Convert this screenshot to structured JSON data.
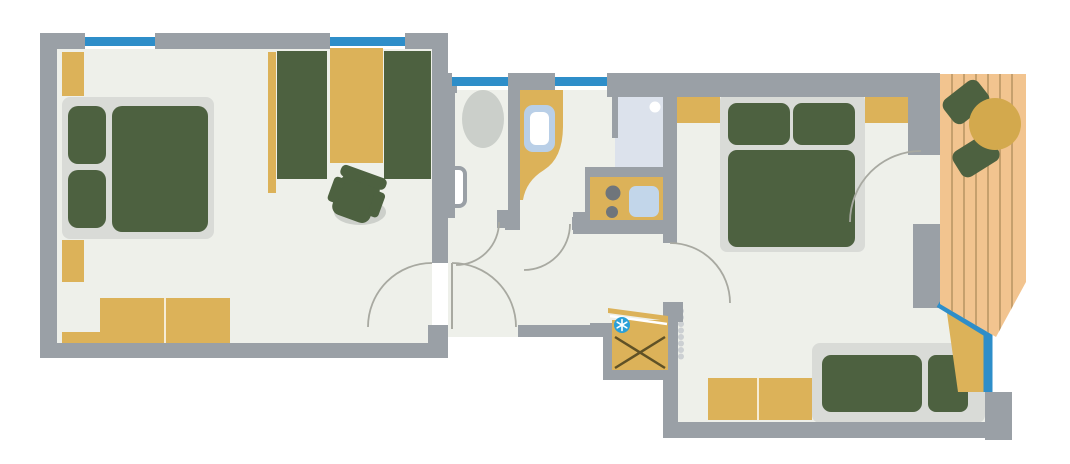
{
  "plan": {
    "type": "apartment-floor-plan",
    "rooms": [
      {
        "name": "bedroom-living-left",
        "furniture": [
          "double-bed",
          "wardrobe",
          "wall-cabinet",
          "sideboard",
          "seating-bench-left",
          "seating-bench-right",
          "desk",
          "desk-chair"
        ]
      },
      {
        "name": "wc",
        "furniture": [
          "toilet",
          "hand-basin"
        ]
      },
      {
        "name": "bathroom",
        "furniture": [
          "vanity-counter",
          "washbasin"
        ]
      },
      {
        "name": "kitchenette-niche",
        "furniture": [
          "shower",
          "kitchen-counter",
          "stove-two-burners",
          "kitchen-sink"
        ]
      },
      {
        "name": "hallway",
        "furniture": [
          "utility-shaft",
          "ac-unit"
        ]
      },
      {
        "name": "bedroom-right",
        "furniture": [
          "double-bed",
          "nightstand-left",
          "nightstand-right",
          "dresser",
          "daybed",
          "radiator",
          "window-bench"
        ]
      },
      {
        "name": "balcony",
        "furniture": [
          "wood-decking",
          "round-table",
          "balcony-chair-upper",
          "balcony-chair-lower"
        ]
      }
    ],
    "window_count": 5,
    "door_count": 6
  },
  "icons": [
    {
      "name": "ac-snowflake-icon",
      "meaning": "air-conditioning / cooling unit"
    },
    {
      "name": "shaft-cross-icon",
      "meaning": "utility shaft crossed box"
    }
  ],
  "colors": {
    "wall": "#9aa0a6",
    "floor": "#eef0ea",
    "exterior": "#ffffff",
    "frame": "#d9dbd7",
    "green": "#4d6140",
    "yellow": "#dcb259",
    "tableYellow": "#d3a94d",
    "blue": "#2e8ec9",
    "deck": "#f2c48f",
    "deckLine": "#c6a06d",
    "shower": "#dce2ec",
    "sinkBlue": "#c2d6ea",
    "basinBorder": "#b9cfe7",
    "appliance": "#6f757b",
    "toilet": "#cbcfca",
    "radiator": "#ccd0d3",
    "arcLine": "#a8a9a1",
    "shadow": "#cdd0cb",
    "xLine": "#5f5126",
    "snowflake": "#2aa0d8"
  }
}
